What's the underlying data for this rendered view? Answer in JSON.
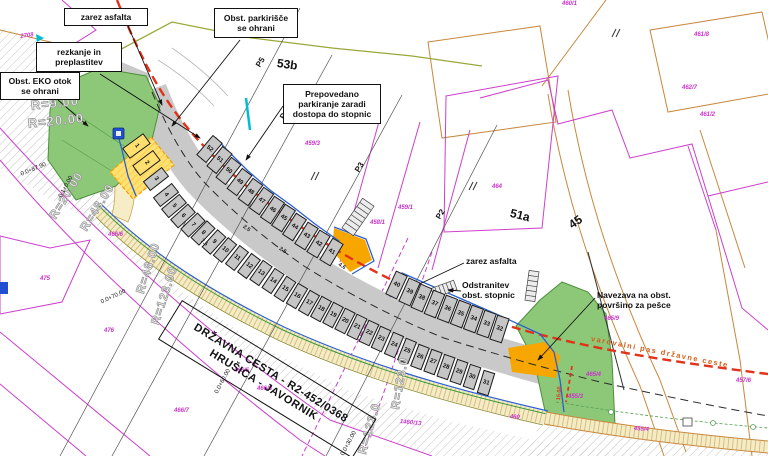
{
  "road_box": {
    "line1": "DRŽAVNA CESTA - R2-452/0368",
    "line2": "HRUŠICA - JAVORNIK"
  },
  "colors": {
    "cadastre_magenta": "#cc3fcc",
    "existing_tan": "#c8883c",
    "boundary_olive": "#9aa83a",
    "road_gray": "#c9c9c9",
    "stall_gray": "#c6c6c6",
    "green_area": "#8cc878",
    "sidewalk_beige": "#f4ebc8",
    "island_orange": "#f7a600",
    "disabled_yellow": "#ffe070",
    "new_edge_blue": "#2b5fd0",
    "marker_cyan": "#00bcd4",
    "protection_red": "#e23218"
  },
  "drawing": {
    "boxed_labels": [
      {
        "id": "label-zarez-asfalta-top",
        "t": "zarez asfalta",
        "x": 64,
        "y": 8,
        "w": 84,
        "h": 18
      },
      {
        "id": "label-obst-parkirisce",
        "t": "Obst. parkirišče\nse ohrani",
        "x": 214,
        "y": 8,
        "w": 84,
        "h": 30
      },
      {
        "id": "label-rezkanje",
        "t": "rezkanje in\npreplastitev",
        "x": 36,
        "y": 42,
        "w": 86,
        "h": 30
      },
      {
        "id": "label-obst-eko-otok",
        "t": "Obst. EKO otok\nse ohrani",
        "x": 0,
        "y": 72,
        "w": 80,
        "h": 28
      },
      {
        "id": "label-prepovedano",
        "t": "Prepovedano\nparkiranje zaradi\ndostopa do stopnic",
        "x": 283,
        "y": 84,
        "w": 98,
        "h": 40
      }
    ],
    "free_labels": [
      {
        "id": "label-zarez-asfalta-right",
        "t": "zarez asfalta",
        "x": 466,
        "y": 256
      },
      {
        "id": "label-odstranitev-stopnic",
        "t": "Odstranitev\nobst. stopnic",
        "x": 462,
        "y": 280
      },
      {
        "id": "label-navezava",
        "t": "Navezava na obst.\npovršino za pešce",
        "x": 597,
        "y": 290
      },
      {
        "id": "label-varovalni-pas",
        "t": "varovalni pas državne ceste",
        "x": 592,
        "y": 334,
        "rot": 11,
        "size": 7.5,
        "color": "#d2601a",
        "ls": 1.5
      },
      {
        "id": "label-building-53b",
        "t": "53b",
        "x": 278,
        "y": 56,
        "rot": 8,
        "size": 12
      },
      {
        "id": "label-building-51a",
        "t": "51a",
        "x": 512,
        "y": 206,
        "rot": 14,
        "size": 12
      },
      {
        "id": "label-road-45",
        "t": "45",
        "x": 566,
        "y": 220,
        "rot": -35,
        "size": 12
      },
      {
        "id": "label-dim-15",
        "t": "15.00",
        "x": 556,
        "y": 400,
        "rot": -85,
        "size": 5.5,
        "color": "#e23218"
      }
    ],
    "radius_labels": [
      {
        "t": "R=9.00",
        "x": 30,
        "y": 98,
        "rot": -6,
        "size": 13
      },
      {
        "t": "R=20.00",
        "x": 27,
        "y": 116,
        "rot": -6,
        "size": 13
      },
      {
        "t": "R=20.00",
        "x": 46,
        "y": 214,
        "rot": -58
      },
      {
        "t": "R=48.00",
        "x": 77,
        "y": 226,
        "rot": -58
      },
      {
        "t": "R=48.00",
        "x": 133,
        "y": 291,
        "rot": -72
      },
      {
        "t": "R=123.00",
        "x": 148,
        "y": 322,
        "rot": -72
      },
      {
        "t": "R=123.0",
        "x": 355,
        "y": 452,
        "rot": -74
      },
      {
        "t": "R=123.0",
        "x": 388,
        "y": 408,
        "rot": -80
      }
    ],
    "chainage_labels": [
      {
        "t": "0.0+87.90",
        "x": 20,
        "y": 172,
        "rot": -22
      },
      {
        "t": "0.1+0.00",
        "x": 58,
        "y": 196,
        "rot": -62
      },
      {
        "t": "0.0+70.00",
        "x": 100,
        "y": 300,
        "rot": -25
      },
      {
        "t": "0.0+60.00",
        "x": 214,
        "y": 392,
        "rot": -62
      },
      {
        "t": "0.0+30.00",
        "x": 340,
        "y": 454,
        "rot": -62
      }
    ],
    "dim_labels": [
      {
        "t": "7.5",
        "x": 203,
        "y": 238,
        "rot": 42
      },
      {
        "t": "2.5",
        "x": 245,
        "y": 224,
        "rot": 36
      },
      {
        "t": "2.5",
        "x": 281,
        "y": 246,
        "rot": 33
      },
      {
        "t": "4.6",
        "x": 340,
        "y": 262,
        "rot": 31
      }
    ],
    "profile_markers": [
      {
        "t": "P5",
        "x": 254,
        "y": 64,
        "rot": -58
      },
      {
        "t": "P4",
        "x": 278,
        "y": 116,
        "rot": -58
      },
      {
        "t": "P3",
        "x": 353,
        "y": 169,
        "rot": -58
      },
      {
        "t": "P2",
        "x": 434,
        "y": 216,
        "rot": -58
      }
    ],
    "parcel_labels": [
      {
        "t": "2708",
        "x": 20,
        "y": 34,
        "rot": -8
      },
      {
        "t": "460/1",
        "x": 562,
        "y": 1
      },
      {
        "t": "461/8",
        "x": 694,
        "y": 32
      },
      {
        "t": "462/7",
        "x": 682,
        "y": 85
      },
      {
        "t": "461/2",
        "x": 700,
        "y": 112
      },
      {
        "t": "459/3",
        "x": 305,
        "y": 141
      },
      {
        "t": "459/1",
        "x": 398,
        "y": 205
      },
      {
        "t": "458/1",
        "x": 370,
        "y": 220
      },
      {
        "t": "464",
        "x": 492,
        "y": 184
      },
      {
        "t": "465/9",
        "x": 604,
        "y": 316
      },
      {
        "t": "465/4",
        "x": 586,
        "y": 372
      },
      {
        "t": "457/6",
        "x": 736,
        "y": 378
      },
      {
        "t": "455/3",
        "x": 568,
        "y": 394
      },
      {
        "t": "455/4",
        "x": 634,
        "y": 426,
        "rot": 4
      },
      {
        "t": "466/6",
        "x": 108,
        "y": 232
      },
      {
        "t": "475",
        "x": 40,
        "y": 276
      },
      {
        "t": "476",
        "x": 104,
        "y": 328
      },
      {
        "t": "466/5",
        "x": 234,
        "y": 368
      },
      {
        "t": "466/8",
        "x": 257,
        "y": 386
      },
      {
        "t": "466/7",
        "x": 174,
        "y": 408
      },
      {
        "t": "1460/13",
        "x": 400,
        "y": 419,
        "rot": 6
      },
      {
        "t": "460",
        "x": 510,
        "y": 414,
        "rot": 6
      }
    ],
    "stalls": [
      [
        1,
        136,
        146,
        54,
        "y"
      ],
      [
        2,
        146,
        163,
        53,
        "y"
      ],
      [
        3,
        156,
        179,
        52,
        "l"
      ],
      [
        4,
        166,
        195,
        52,
        "l"
      ],
      [
        5,
        174,
        206,
        50,
        "l"
      ],
      [
        6,
        183,
        216,
        48,
        "l"
      ],
      [
        7,
        193,
        225,
        46,
        "l"
      ],
      [
        8,
        203,
        233,
        44,
        "l"
      ],
      [
        9,
        214,
        242,
        42,
        "l"
      ],
      [
        10,
        225,
        250,
        40,
        "l"
      ],
      [
        11,
        237,
        258,
        38,
        "l"
      ],
      [
        12,
        249,
        266,
        37,
        "l"
      ],
      [
        13,
        261,
        273,
        35,
        "l"
      ],
      [
        14,
        273,
        281,
        34,
        "l"
      ],
      [
        15,
        285,
        289,
        33,
        "l"
      ],
      [
        16,
        297,
        296,
        31,
        "l"
      ],
      [
        17,
        309,
        303,
        30,
        "l"
      ],
      [
        18,
        321,
        309,
        29,
        "l"
      ],
      [
        19,
        333,
        315,
        28,
        "l"
      ],
      [
        20,
        345,
        321,
        27,
        "l"
      ],
      [
        21,
        357,
        327,
        26,
        "l"
      ],
      [
        22,
        369,
        333,
        25,
        "l"
      ],
      [
        23,
        381,
        339,
        24,
        "l"
      ],
      [
        24,
        394,
        345,
        23,
        "l"
      ],
      [
        25,
        407,
        351,
        22,
        "l"
      ],
      [
        26,
        420,
        357,
        21,
        "l"
      ],
      [
        27,
        433,
        362,
        20,
        "l"
      ],
      [
        28,
        446,
        367,
        19,
        "l"
      ],
      [
        29,
        459,
        372,
        19,
        "l"
      ],
      [
        30,
        472,
        377,
        18,
        "l"
      ],
      [
        31,
        486,
        383,
        17,
        "l"
      ],
      [
        41,
        331,
        252,
        31,
        "u"
      ],
      [
        42,
        318,
        244,
        31,
        "u"
      ],
      [
        43,
        306,
        236,
        32,
        "u"
      ],
      [
        44,
        294,
        227,
        33,
        "u"
      ],
      [
        45,
        283,
        218,
        33,
        "u"
      ],
      [
        46,
        272,
        210,
        34,
        "u"
      ],
      [
        47,
        261,
        201,
        35,
        "u"
      ],
      [
        48,
        250,
        192,
        36,
        "u"
      ],
      [
        49,
        239,
        182,
        37,
        "u"
      ],
      [
        50,
        228,
        171,
        38,
        "u"
      ],
      [
        51,
        219,
        160,
        39,
        "u"
      ],
      [
        52,
        209,
        149,
        40,
        "u"
      ],
      [
        32,
        499,
        329,
        18,
        "u"
      ],
      [
        33,
        486,
        324,
        19,
        "u"
      ],
      [
        34,
        473,
        319,
        20,
        "u"
      ],
      [
        35,
        460,
        314,
        21,
        "u"
      ],
      [
        36,
        447,
        309,
        21,
        "u"
      ],
      [
        37,
        434,
        304,
        22,
        "u"
      ],
      [
        38,
        421,
        298,
        23,
        "u"
      ],
      [
        39,
        409,
        292,
        24,
        "u"
      ],
      [
        40,
        396,
        285,
        25,
        "u"
      ]
    ]
  }
}
